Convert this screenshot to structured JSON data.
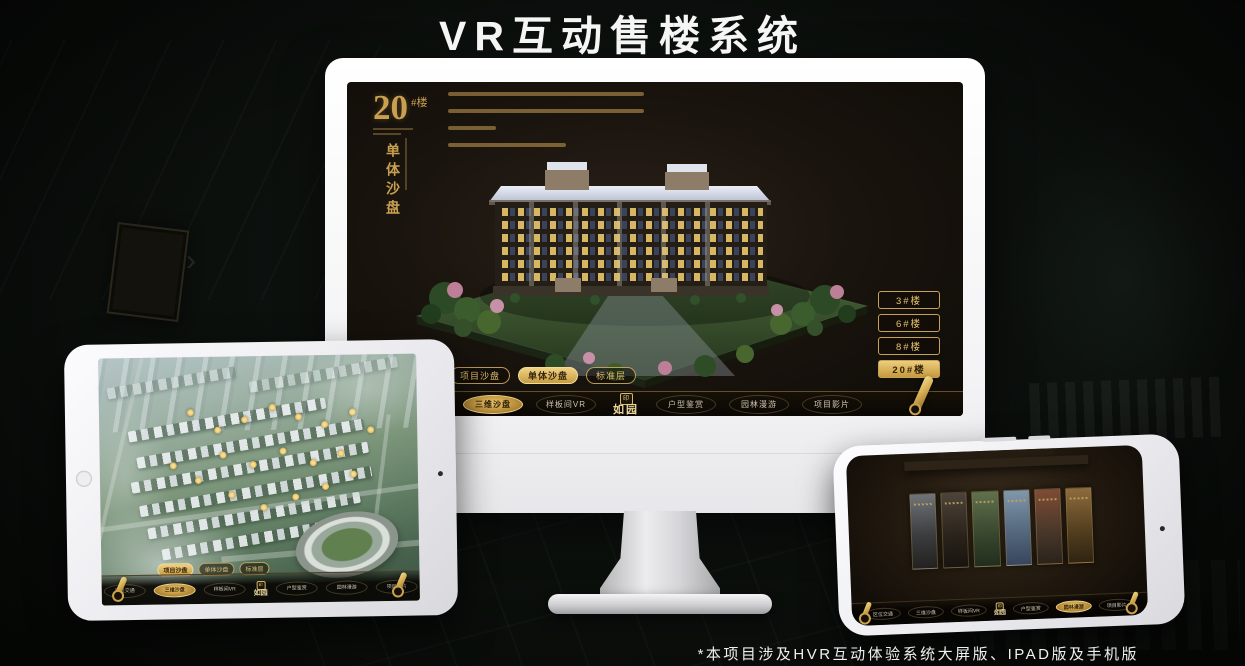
{
  "page": {
    "title": "VR互动售楼系统",
    "footnote": "*本项目涉及HVR互动体验系统大屏版、IPAD版及手机版"
  },
  "colors": {
    "gold_accent": "#d4a94f",
    "screen_background": "#17120d",
    "device_white": "#f4f4f6"
  },
  "app": {
    "logo": "如园",
    "nav_items": [
      {
        "label": "区位交通"
      },
      {
        "label": "三维沙盘"
      },
      {
        "label": "样板间VR"
      },
      {
        "label": "户型鉴赏"
      },
      {
        "label": "园林漫游"
      },
      {
        "label": "项目影片"
      }
    ]
  },
  "monitor": {
    "heading": {
      "number": "20",
      "suffix": "#楼",
      "subtitle": "单体沙盘"
    },
    "building_buttons": [
      {
        "label": "3#楼"
      },
      {
        "label": "6#楼"
      },
      {
        "label": "8#楼"
      },
      {
        "label": "20#楼"
      }
    ],
    "sub_tabs": [
      {
        "label": "项目沙盘"
      },
      {
        "label": "单体沙盘"
      },
      {
        "label": "标准层"
      }
    ]
  },
  "tablet": {
    "sub_tabs": [
      {
        "label": "项目沙盘"
      },
      {
        "label": "单体沙盘"
      },
      {
        "label": "标准层"
      }
    ]
  }
}
